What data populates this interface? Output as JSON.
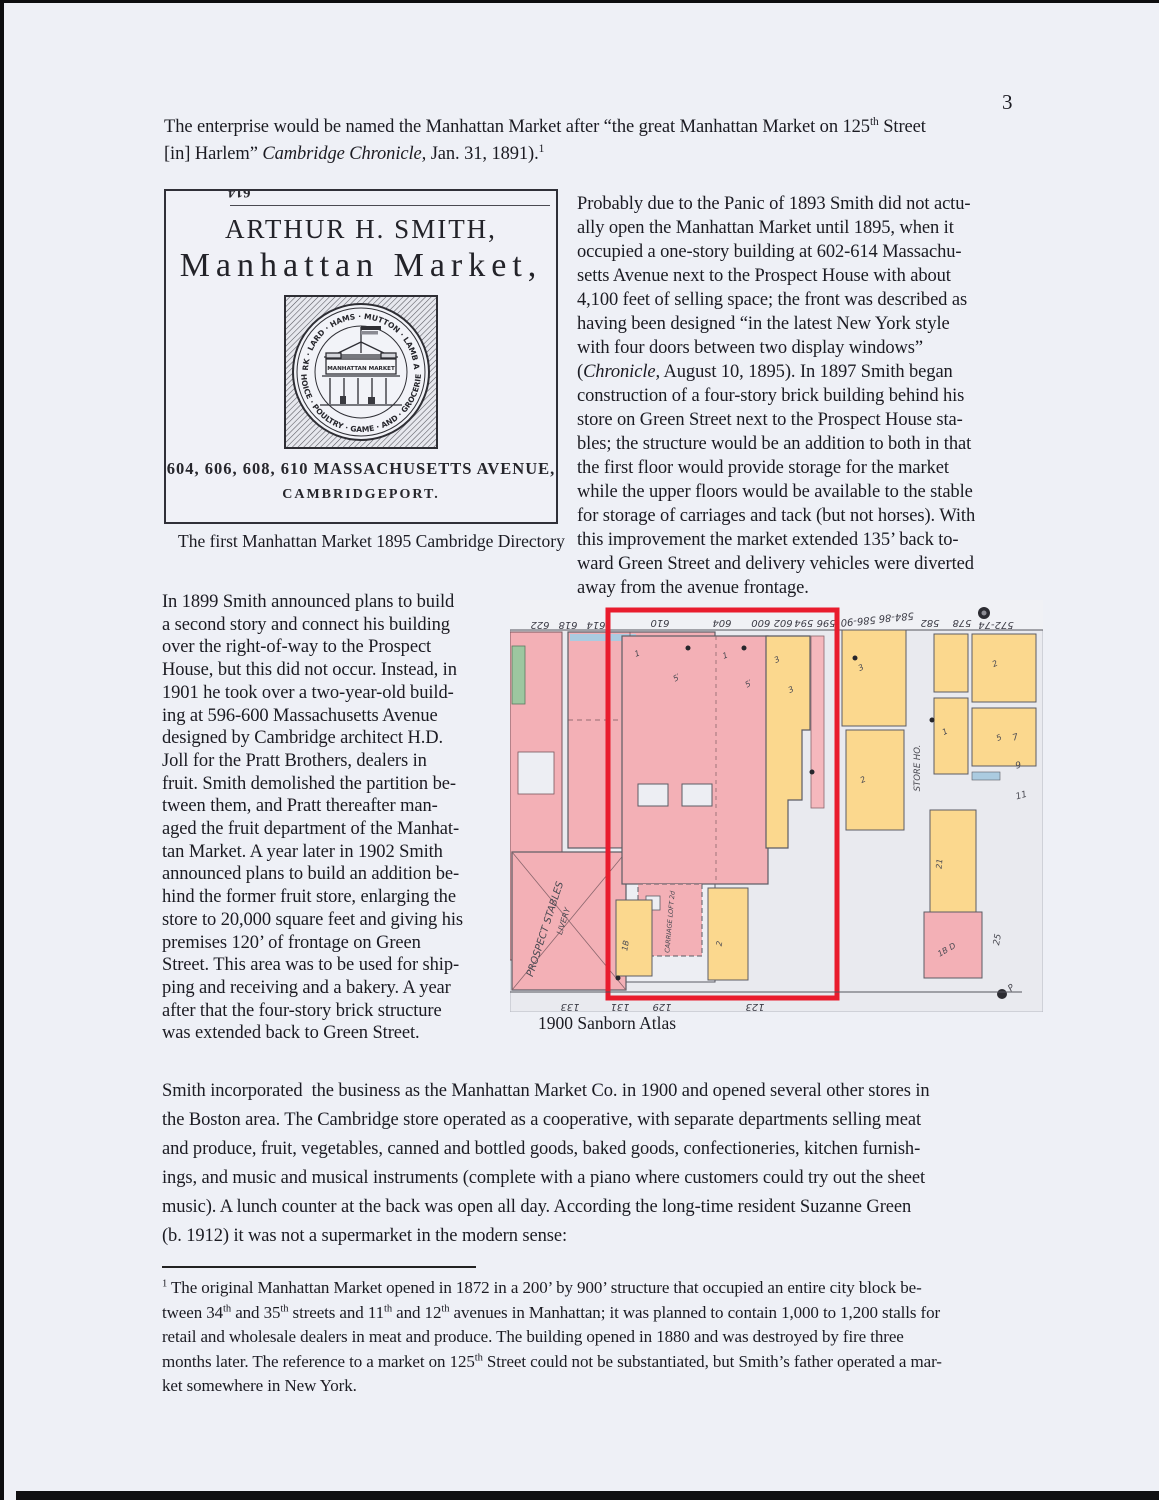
{
  "page": {
    "number": "3"
  },
  "intro": {
    "lines": [
      [
        "The enterprise would be named the Manhattan Market after “the great Manhattan Market on 125",
        {
          "t": "th",
          "sup": true
        },
        " Street"
      ],
      [
        "[in] Harlem” ",
        {
          "t": "Cambridge Chronicle,",
          "i": true
        },
        " Jan. 31, 1891).",
        {
          "t": "1",
          "sup": true
        }
      ]
    ]
  },
  "ad": {
    "partial_top": "614",
    "title": "ARTHUR H. SMITH,",
    "subtitle": "Manhattan Market,",
    "seal": {
      "arc_top": "BEEF · PORK · LARD · HAMS · MUTTON · LAMB AND · VEAL",
      "arc_bottom": "CHOICE · POULTRY · GAME · AND · GROCERIES",
      "sign": "MANHATTAN MARKET"
    },
    "address_line1": "604, 606, 608, 610 MASSACHUSETTS AVENUE,",
    "address_line2": "CAMBRIDGEPORT.",
    "caption": "The first Manhattan Market  1895 Cambridge Directory"
  },
  "columns": {
    "right": {
      "lines": [
        "Probably due to the Panic of 1893 Smith did not actu-",
        "ally open the Manhattan Market until 1895, when it",
        "occupied a one-story building at 602-614 Massachu-",
        "setts Avenue next to the Prospect House with about",
        "4,100 feet of selling space; the front was described as",
        "having been designed “in the latest New York style",
        "with four doors between two display windows”",
        [
          "(",
          {
            "t": "Chronicle,",
            "i": true
          },
          " August 10, 1895). In 1897 Smith began"
        ],
        "construction of a four-story brick building behind his",
        "store on Green Street next to the Prospect House sta-",
        "bles; the structure would be an addition to both in that",
        "the first floor would provide storage for the market",
        "while the upper floors would be available to the stable",
        "for storage of carriages and tack (but not horses). With",
        "this improvement the market extended 135’ back to-",
        "ward Green Street and delivery vehicles were diverted",
        "away from the avenue frontage."
      ]
    },
    "left": {
      "lines": [
        "In 1899 Smith announced plans to build",
        "a second story and connect his building",
        "over the right-of-way to the Prospect",
        "House, but this did not occur. Instead, in",
        "1901 he took over a two-year-old build-",
        "ing at 596-600 Massachusetts Avenue",
        "designed by Cambridge architect H.D.",
        "Joll for the Pratt Brothers, dealers in",
        "fruit. Smith demolished the partition be-",
        "tween them, and Pratt thereafter man-",
        "aged the fruit department of the Manhat-",
        "tan Market. A year later in 1902 Smith",
        "announced plans to build an addition be-",
        "hind the former fruit store, enlarging the",
        "store to 20,000 square feet and giving his",
        "premises 120’ of frontage on Green",
        "Street. This area was to be used for ship-",
        "ping and receiving and a bakery. A year",
        "after that the four-story brick structure",
        "was extended back to Green Street."
      ]
    }
  },
  "map": {
    "caption": "1900 Sanborn Atlas",
    "colors": {
      "brick_pink": "#f3b0b6",
      "frame_yellow": "#fbd88e",
      "highlight_red": "#e91c2d",
      "green": "#9dc7a0",
      "blue": "#abcbe0"
    },
    "street_numbers_top": [
      "622",
      "618",
      "614",
      "610",
      "604",
      "602 600",
      "596 594",
      "586-90",
      "584-86",
      "582",
      "578",
      "572-74"
    ],
    "street_numbers_bottom": [
      "133",
      "131",
      "129",
      "123"
    ],
    "labels": {
      "prospect_house": "PROSPECT HO.",
      "stables": "PROSPECT STABLES",
      "livery": "LIVERY",
      "carriage_loft": "CARRIAGE LOFT 2d",
      "store_house": "STORE HO."
    },
    "marks": [
      "1",
      "5′",
      "1",
      "5′",
      "3",
      "3",
      "2",
      "1B",
      "2",
      "2",
      "3",
      "2",
      "5",
      "1",
      "21",
      "1B D",
      "7",
      "9",
      "11",
      "25",
      "P"
    ]
  },
  "body": {
    "lines": [
      "Smith incorporated  the business as the Manhattan Market Co. in 1900 and opened several other stores in",
      "the Boston area. The Cambridge store operated as a cooperative, with separate departments selling meat",
      "and produce, fruit, vegetables, canned and bottled goods, baked goods, confectioneries, kitchen furnish-",
      "ings, and music and musical instruments (complete with a piano where customers could try out the sheet",
      "music). A lunch counter at the back was open all day. According the long-time resident Suzanne Green",
      "(b. 1912) it was not a supermarket in the modern sense:"
    ]
  },
  "footnote": {
    "lines": [
      [
        {
          "t": "1",
          "sup": true
        },
        " The original Manhattan Market opened in 1872 in a 200’ by 900’ structure that occupied an entire city block be-"
      ],
      [
        "tween 34",
        {
          "t": "th",
          "sup": true
        },
        " and 35",
        {
          "t": "th",
          "sup": true
        },
        " streets and 11",
        {
          "t": "th",
          "sup": true
        },
        " and 12",
        {
          "t": "th",
          "sup": true
        },
        " avenues in Manhattan; it was planned to contain 1,000 to 1,200 stalls for"
      ],
      "retail and wholesale dealers in meat and produce. The building opened in 1880 and was destroyed by fire three",
      [
        "months later. The reference to a market on 125",
        {
          "t": "th",
          "sup": true
        },
        " Street could not be substantiated, but Smith’s father operated a mar-"
      ],
      "ket somewhere in New York."
    ]
  }
}
